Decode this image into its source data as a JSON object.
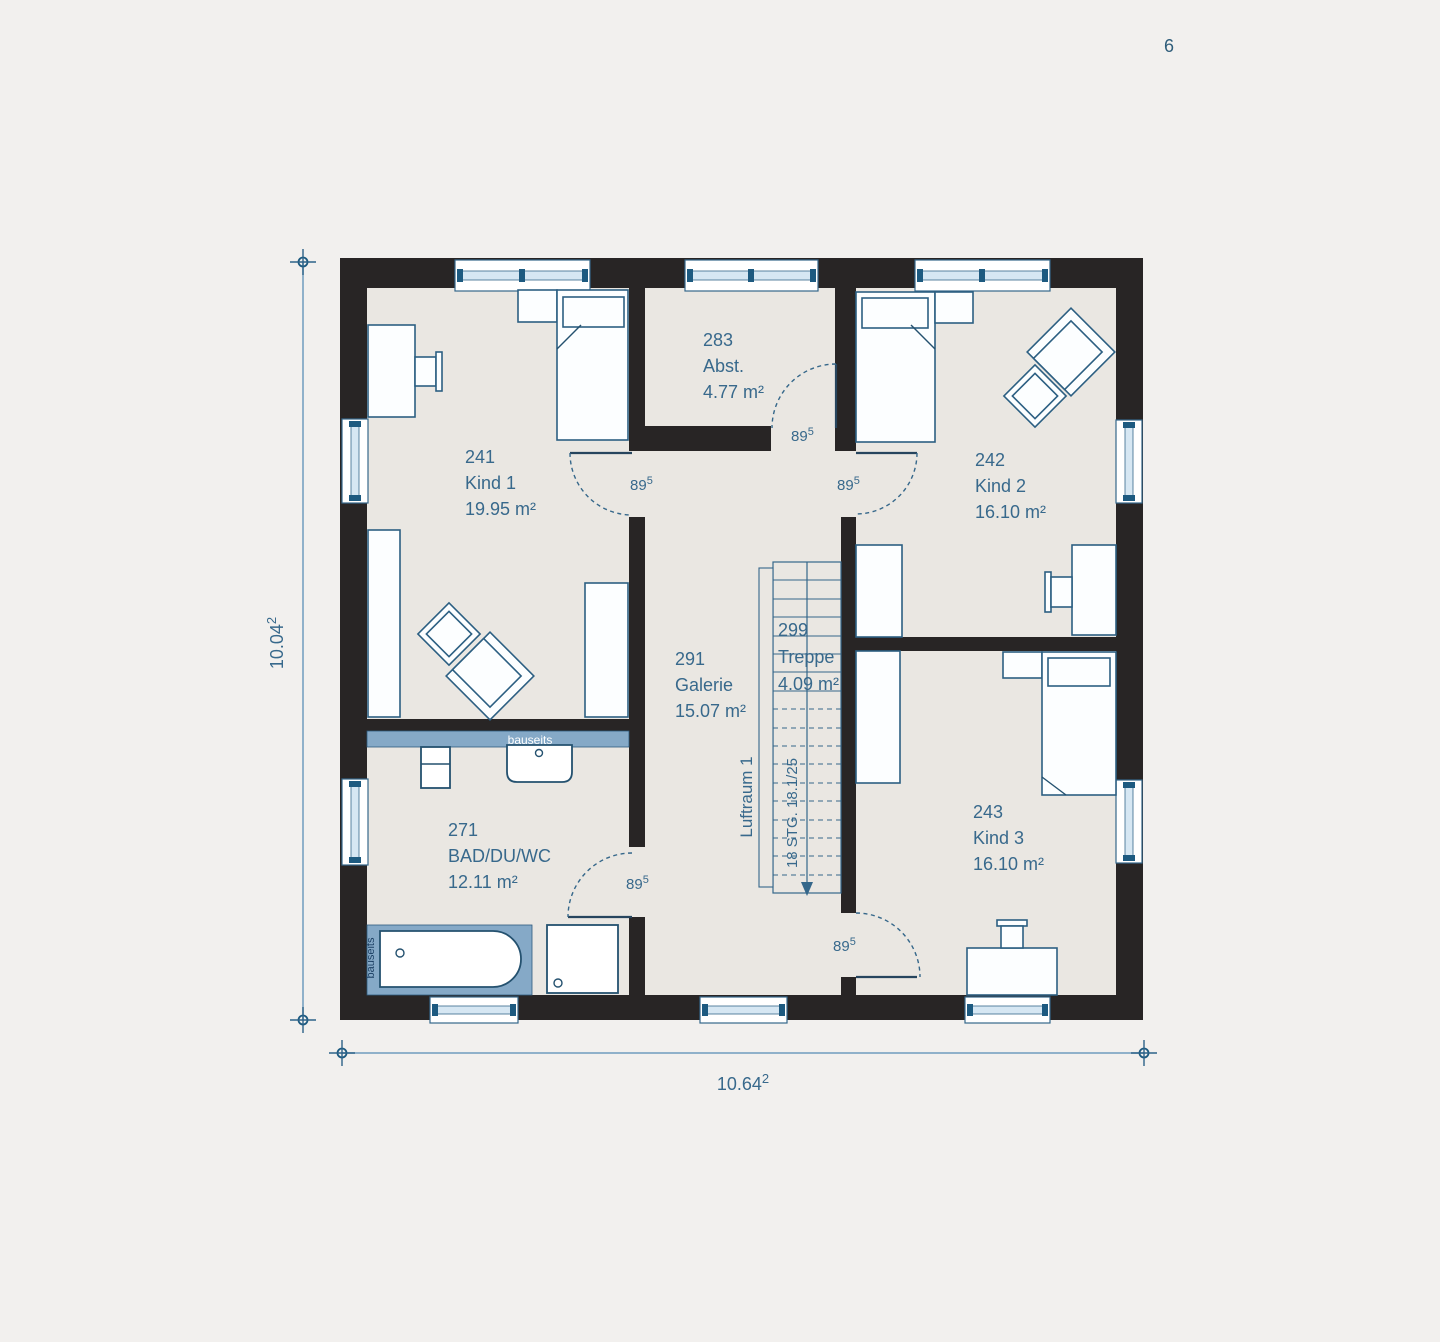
{
  "page": {
    "number": "6"
  },
  "plan": {
    "rooms": [
      {
        "id": "241",
        "name": "Kind 1",
        "area": "19.95 m²"
      },
      {
        "id": "242",
        "name": "Kind 2",
        "area": "16.10 m²"
      },
      {
        "id": "243",
        "name": "Kind 3",
        "area": "16.10 m²"
      },
      {
        "id": "271",
        "name": "BAD/DU/WC",
        "area": "12.11 m²"
      },
      {
        "id": "283",
        "name": "Abst.",
        "area": "4.77 m²"
      },
      {
        "id": "291",
        "name": "Galerie",
        "area": "15.07 m²"
      },
      {
        "id": "299",
        "name": "Treppe",
        "area": "4.09 m²"
      }
    ],
    "stairs": {
      "note": "18 STG. 18.1/25"
    },
    "void_label": "Luftraum 1",
    "site_labels": {
      "counter": "bauseits",
      "tub": "bauseits"
    },
    "doors": [
      {
        "main": "89",
        "sup": "5"
      },
      {
        "main": "89",
        "sup": "5"
      },
      {
        "main": "89",
        "sup": "5"
      },
      {
        "main": "89",
        "sup": "5"
      },
      {
        "main": "89",
        "sup": "5"
      }
    ],
    "dimensions": {
      "left": {
        "main": "10.04",
        "sup": "2"
      },
      "bottom": {
        "main": "10.64",
        "sup": "2"
      }
    },
    "colors": {
      "background": "#f2f0ee",
      "floor": "#eae7e2",
      "wall": "#282525",
      "accent_blue": "#38698c",
      "fixture_blue": "#85a9c7",
      "glazing": "#d6e7f3",
      "mullion": "#1d5a80"
    }
  }
}
